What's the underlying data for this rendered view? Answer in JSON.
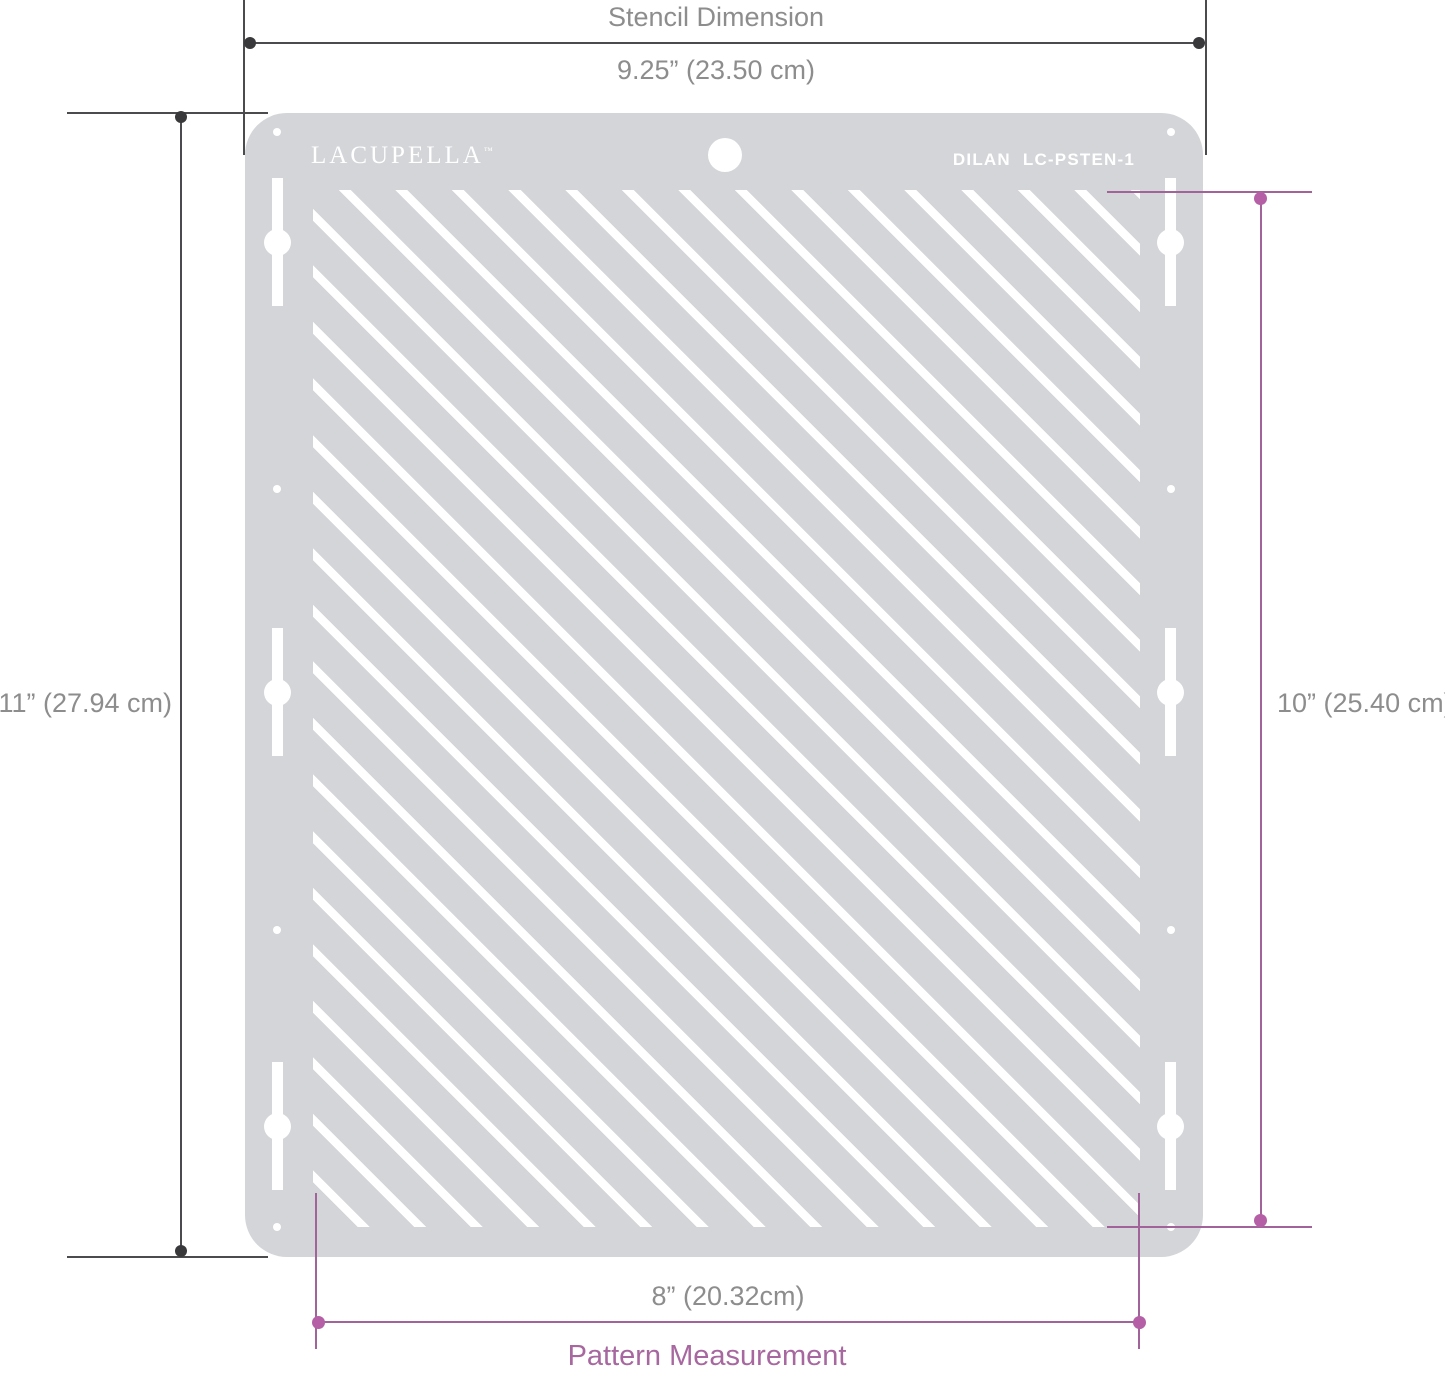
{
  "stencil": {
    "brand": "LACUPELLA",
    "trademark": "™",
    "model_name": "DILAN",
    "model_code": "LC-PSTEN-1"
  },
  "dimensions": {
    "stencil": {
      "title": "Stencil Dimension",
      "width": "9.25” (23.50 cm)",
      "height": "11” (27.94 cm)"
    },
    "pattern": {
      "title": "Pattern Measurement",
      "width": "8” (20.32cm)",
      "height": "10” (25.40 cm)"
    }
  },
  "colors": {
    "stencil_body": "#d3d5d8",
    "stripe_and_holes": "#ffffff",
    "stencil_dimension_line": "#4b4b4d",
    "stencil_dimension_dot": "#39393b",
    "stencil_dimension_text": "#8d8d8d",
    "pattern_dimension_line": "#a2639a",
    "pattern_dimension_dot": "#b45fa6",
    "pattern_dimension_text": "#a768a0"
  }
}
